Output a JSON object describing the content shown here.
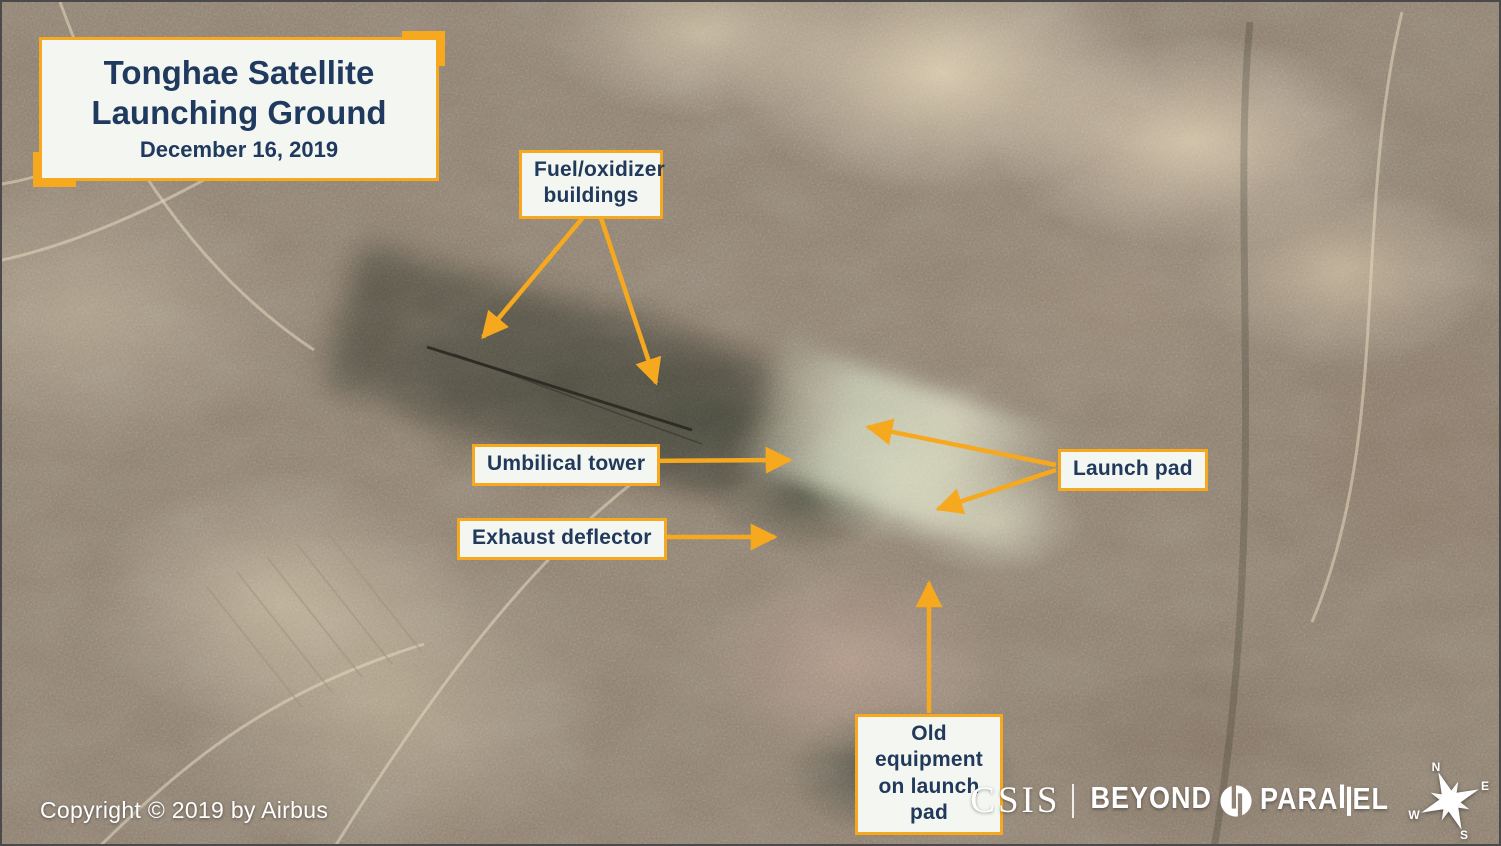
{
  "colors": {
    "accent_orange": "#F6A81F",
    "text_navy": "#21395B",
    "label_background": "#F3F6F1",
    "footer_text": "#FFFFFF"
  },
  "title_box": {
    "line1": "Tonghae Satellite",
    "line2": "Launching Ground",
    "date": "December 16, 2019"
  },
  "labels": {
    "fuel_oxidizer": {
      "line1": "Fuel/oxidizer",
      "line2": "buildings"
    },
    "umbilical_tower": {
      "text": "Umbilical tower"
    },
    "exhaust_deflector": {
      "text": "Exhaust deflector"
    },
    "launch_pad": {
      "text": "Launch pad"
    },
    "old_equipment": {
      "line1": "Old equipment",
      "line2": "on launch pad"
    }
  },
  "footer": {
    "copyright": "Copyright © 2019 by Airbus",
    "logo": {
      "csis": "CSIS",
      "beyond": "BEYOND",
      "parallel_prefix": "PARA",
      "parallel_suffix": "EL"
    },
    "compass": {
      "north": "N",
      "east": "E",
      "south": "S",
      "west": "W"
    }
  }
}
